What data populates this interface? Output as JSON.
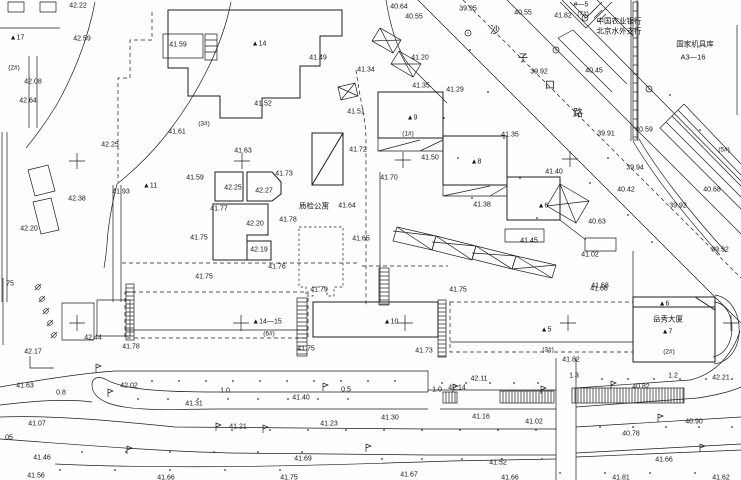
{
  "map_title": "topographic survey plan",
  "colors": {
    "ink": "#1c1c1c",
    "paper": "#fefefe"
  },
  "road_name_chars": [
    {
      "t": "沙",
      "x": 495,
      "y": 31
    },
    {
      "t": "子",
      "x": 523,
      "y": 59
    },
    {
      "t": "口",
      "x": 550,
      "y": 86
    },
    {
      "t": "路",
      "x": 578,
      "y": 114
    }
  ],
  "names": [
    {
      "t": "中国农业银行",
      "x": 619,
      "y": 21
    },
    {
      "t": "北京水外支行",
      "x": 619,
      "y": 31
    },
    {
      "t": "国家机具库",
      "x": 695,
      "y": 44
    },
    {
      "t": "A3—16",
      "x": 693,
      "y": 57
    },
    {
      "t": "质检公寓",
      "x": 314,
      "y": 206
    },
    {
      "t": "岳秀大厦",
      "x": 668,
      "y": 319
    }
  ],
  "building_labels": [
    {
      "t": "▲17",
      "x": 17,
      "y": 37
    },
    {
      "t": "▲14",
      "x": 259,
      "y": 43
    },
    {
      "t": "▲11",
      "x": 150,
      "y": 185
    },
    {
      "t": "▲9",
      "x": 412,
      "y": 117
    },
    {
      "t": "▲8",
      "x": 476,
      "y": 161
    },
    {
      "t": "▲6",
      "x": 543,
      "y": 205
    },
    {
      "t": "▲14—15",
      "x": 267,
      "y": 321
    },
    {
      "t": "▲10",
      "x": 391,
      "y": 321
    },
    {
      "t": "▲5",
      "x": 546,
      "y": 329
    },
    {
      "t": "▲6",
      "x": 664,
      "y": 303
    },
    {
      "t": "▲7",
      "x": 667,
      "y": 331
    },
    {
      "t": "#—5",
      "x": 581,
      "y": 4
    }
  ],
  "unit_labels": [
    {
      "t": "(2#)",
      "x": 14,
      "y": 67
    },
    {
      "t": "(3#)",
      "x": 204,
      "y": 123
    },
    {
      "t": "(1#)",
      "x": 408,
      "y": 133
    },
    {
      "t": "(5#)",
      "x": 724,
      "y": 149
    },
    {
      "t": "(6#)",
      "x": 269,
      "y": 333
    },
    {
      "t": "(3#)",
      "x": 548,
      "y": 349
    },
    {
      "t": "(2#)",
      "x": 669,
      "y": 351
    },
    {
      "t": "(7#)",
      "x": 583,
      "y": 13
    }
  ],
  "width_labels": [
    {
      "t": "0.8",
      "x": 61,
      "y": 392
    },
    {
      "t": "1.0",
      "x": 225,
      "y": 390
    },
    {
      "t": "0.5",
      "x": 346,
      "y": 389
    },
    {
      "t": "1.0",
      "x": 437,
      "y": 389
    },
    {
      "t": "1.3",
      "x": 574,
      "y": 375
    },
    {
      "t": "1.2",
      "x": 673,
      "y": 375
    }
  ],
  "elevations": [
    {
      "t": "42.22",
      "x": 78,
      "y": 5
    },
    {
      "t": "42.59",
      "x": 82,
      "y": 38
    },
    {
      "t": "41.59",
      "x": 178,
      "y": 44
    },
    {
      "t": "42.08",
      "x": 33,
      "y": 81
    },
    {
      "t": "42.64",
      "x": 28,
      "y": 100
    },
    {
      "t": "42.25",
      "x": 110,
      "y": 144
    },
    {
      "t": "41.61",
      "x": 177,
      "y": 131
    },
    {
      "t": "41.49",
      "x": 318,
      "y": 57
    },
    {
      "t": "41.52",
      "x": 263,
      "y": 103
    },
    {
      "t": "41.51",
      "x": 356,
      "y": 111
    },
    {
      "t": "41.34",
      "x": 366,
      "y": 69
    },
    {
      "t": "40.64",
      "x": 399,
      "y": 6
    },
    {
      "t": "40.55",
      "x": 414,
      "y": 16
    },
    {
      "t": "40.55",
      "x": 523,
      "y": 12
    },
    {
      "t": "39.95",
      "x": 468,
      "y": 8
    },
    {
      "t": "41.82",
      "x": 563,
      "y": 15
    },
    {
      "t": "39.92",
      "x": 539,
      "y": 71
    },
    {
      "t": "40.45",
      "x": 594,
      "y": 70
    },
    {
      "t": "41.20",
      "x": 420,
      "y": 57
    },
    {
      "t": "41.35",
      "x": 421,
      "y": 85
    },
    {
      "t": "41.29",
      "x": 455,
      "y": 89
    },
    {
      "t": "41.35",
      "x": 510,
      "y": 134
    },
    {
      "t": "41.50",
      "x": 430,
      "y": 157
    },
    {
      "t": "41.72",
      "x": 358,
      "y": 149
    },
    {
      "t": "41.70",
      "x": 389,
      "y": 177
    },
    {
      "t": "41.63",
      "x": 243,
      "y": 150
    },
    {
      "t": "41.59",
      "x": 195,
      "y": 177
    },
    {
      "t": "42.25",
      "x": 233,
      "y": 187
    },
    {
      "t": "42.27",
      "x": 264,
      "y": 190
    },
    {
      "t": "41.73",
      "x": 284,
      "y": 173
    },
    {
      "t": "41.77",
      "x": 219,
      "y": 208
    },
    {
      "t": "42.20",
      "x": 255,
      "y": 223
    },
    {
      "t": "41.78",
      "x": 288,
      "y": 219
    },
    {
      "t": "41.75",
      "x": 199,
      "y": 237
    },
    {
      "t": "42.19",
      "x": 259,
      "y": 249
    },
    {
      "t": "41.76",
      "x": 277,
      "y": 266
    },
    {
      "t": "41.75",
      "x": 204,
      "y": 276
    },
    {
      "t": "42.38",
      "x": 77,
      "y": 198
    },
    {
      "t": "41.93",
      "x": 121,
      "y": 191
    },
    {
      "t": "42.20",
      "x": 29,
      "y": 228
    },
    {
      "t": "41.64",
      "x": 347,
      "y": 205
    },
    {
      "t": "41.65",
      "x": 361,
      "y": 238
    },
    {
      "t": "41.38",
      "x": 482,
      "y": 204
    },
    {
      "t": "41.40",
      "x": 554,
      "y": 171
    },
    {
      "t": "41.45",
      "x": 529,
      "y": 240
    },
    {
      "t": "40.63",
      "x": 597,
      "y": 221
    },
    {
      "t": "40.42",
      "x": 626,
      "y": 189
    },
    {
      "t": "39.94",
      "x": 635,
      "y": 167
    },
    {
      "t": "39.92",
      "x": 678,
      "y": 205
    },
    {
      "t": "39.92",
      "x": 720,
      "y": 249
    },
    {
      "t": "40.68",
      "x": 712,
      "y": 189
    },
    {
      "t": "40.59",
      "x": 644,
      "y": 129
    },
    {
      "t": "39.91",
      "x": 606,
      "y": 133
    },
    {
      "t": "41.02",
      "x": 590,
      "y": 254
    },
    {
      "t": "41.68",
      "x": 600,
      "y": 285
    },
    {
      "t": "42.17",
      "x": 33,
      "y": 351
    },
    {
      "t": "42.44",
      "x": 93,
      "y": 337
    },
    {
      "t": "41.78",
      "x": 131,
      "y": 346
    },
    {
      "t": "41.63",
      "x": 25,
      "y": 385
    },
    {
      "t": "42.02",
      "x": 129,
      "y": 385
    },
    {
      "t": "41.31",
      "x": 194,
      "y": 403
    },
    {
      "t": "41.07",
      "x": 37,
      "y": 423
    },
    {
      "t": "41.21",
      "x": 238,
      "y": 426
    },
    {
      "t": "41.23",
      "x": 329,
      "y": 423
    },
    {
      "t": "41.46",
      "x": 42,
      "y": 457
    },
    {
      "t": "41.56",
      "x": 36,
      "y": 475
    },
    {
      "t": "41.66",
      "x": 166,
      "y": 477
    },
    {
      "t": "41.75",
      "x": 289,
      "y": 477
    },
    {
      "t": "41.79",
      "x": 319,
      "y": 289
    },
    {
      "t": "41.75",
      "x": 458,
      "y": 289
    },
    {
      "t": "41.75",
      "x": 306,
      "y": 348
    },
    {
      "t": "41.73",
      "x": 424,
      "y": 350
    },
    {
      "t": "41.40",
      "x": 301,
      "y": 397
    },
    {
      "t": "42.14",
      "x": 457,
      "y": 387
    },
    {
      "t": "42.11",
      "x": 479,
      "y": 378
    },
    {
      "t": "41.30",
      "x": 390,
      "y": 417
    },
    {
      "t": "41.16",
      "x": 481,
      "y": 416
    },
    {
      "t": "41.02",
      "x": 534,
      "y": 421
    },
    {
      "t": "40.78",
      "x": 631,
      "y": 433
    },
    {
      "t": "40.90",
      "x": 694,
      "y": 421
    },
    {
      "t": "41.52",
      "x": 498,
      "y": 462
    },
    {
      "t": "41.66",
      "x": 664,
      "y": 459
    },
    {
      "t": "41.69",
      "x": 303,
      "y": 458
    },
    {
      "t": "41.67",
      "x": 409,
      "y": 474
    },
    {
      "t": "41.66",
      "x": 510,
      "y": 477
    },
    {
      "t": "41.81",
      "x": 621,
      "y": 477
    },
    {
      "t": "41.62",
      "x": 721,
      "y": 477
    },
    {
      "t": "41.82",
      "x": 571,
      "y": 359
    },
    {
      "t": "40.82",
      "x": 641,
      "y": 386
    },
    {
      "t": "42.21",
      "x": 721,
      "y": 377
    },
    {
      "t": "41.68",
      "x": 599,
      "y": 288
    },
    {
      "t": "75",
      "x": 10,
      "y": 283
    },
    {
      "t": ".05",
      "x": 8,
      "y": 437
    }
  ],
  "survey_crosses": [
    [
      77,
      161
    ],
    [
      242,
      161
    ],
    [
      403,
      160
    ],
    [
      570,
      159
    ],
    [
      77,
      323
    ],
    [
      241,
      323
    ],
    [
      405,
      323
    ],
    [
      568,
      323
    ],
    [
      731,
      323
    ]
  ],
  "symbols": {
    "lamps": [
      [
        108,
        397
      ],
      [
        216,
        431
      ],
      [
        323,
        391
      ],
      [
        453,
        392
      ],
      [
        611,
        389
      ],
      [
        658,
        422
      ],
      [
        263,
        433
      ],
      [
        127,
        454
      ],
      [
        541,
        394
      ],
      [
        700,
        452
      ],
      [
        366,
        452
      ],
      [
        96,
        372
      ]
    ],
    "slash_marks": [
      [
        38,
        287
      ],
      [
        42,
        299
      ],
      [
        46,
        311
      ],
      [
        50,
        323
      ],
      [
        54,
        335
      ]
    ],
    "trees": [
      [
        585,
        18
      ],
      [
        468,
        33
      ],
      [
        649,
        89
      ],
      [
        556,
        50
      ]
    ]
  }
}
